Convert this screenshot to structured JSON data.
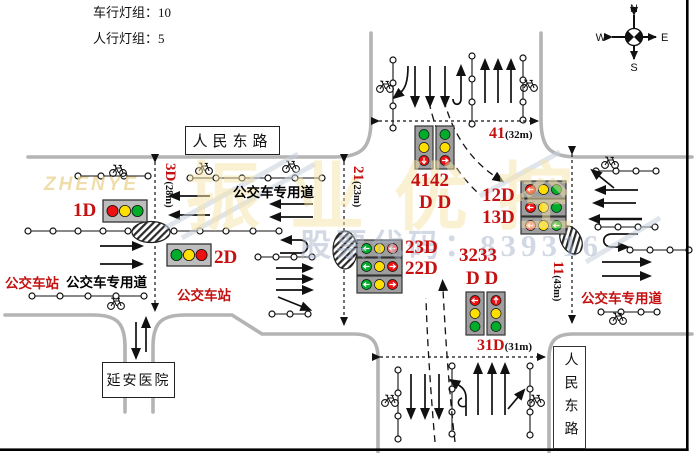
{
  "header": {
    "vehicle_signal_groups_label": "车行灯组：",
    "vehicle_signal_groups_value": "10",
    "pedestrian_signal_groups_label": "人行灯组：",
    "pedestrian_signal_groups_value": "5"
  },
  "compass": {
    "north": "N",
    "south": "S",
    "east": "E",
    "west": "W"
  },
  "roads": {
    "renmin_east_road_top": "人民东路",
    "renmin_east_road_right": "人民东路",
    "yanan_hospital": "延安医院"
  },
  "lanes": {
    "bus_lane_top": "公交车专用道",
    "bus_stop_left": "公交车站",
    "bus_lane_left": "公交车专用道",
    "bus_stop_center": "公交车站",
    "bus_lane_right": "公交车专用道"
  },
  "signals": {
    "s1d": "1D",
    "s2d": "2D",
    "s12d": "12D",
    "s13d": "13D",
    "s23d": "23D",
    "s22d": "22D",
    "s4142": "4142",
    "s4142_sub": "D D",
    "s3233": "3233",
    "s3233_sub": "D D"
  },
  "dimensions": {
    "west_crosswalk_id": "3D",
    "west_crosswalk_len": "(28m)",
    "north_inner_id": "21",
    "north_inner_len": "(23m)",
    "north_crosswalk_id": "41",
    "north_crosswalk_len": "(32m)",
    "south_crosswalk_id": "31D",
    "south_crosswalk_len": "(31m)",
    "east_crosswalk_id": "11",
    "east_crosswalk_len": "(43m)"
  },
  "watermark": {
    "brand_latin": "ZHENYE",
    "brand_cn": "振业优控",
    "stock_code": "股票代码：839316"
  },
  "colors": {
    "accent_red": "#c41111",
    "road_gray": "#b4b4b4",
    "light_red": "#ee1111",
    "light_yellow": "#ffdf00",
    "light_green": "#00ad2b"
  }
}
